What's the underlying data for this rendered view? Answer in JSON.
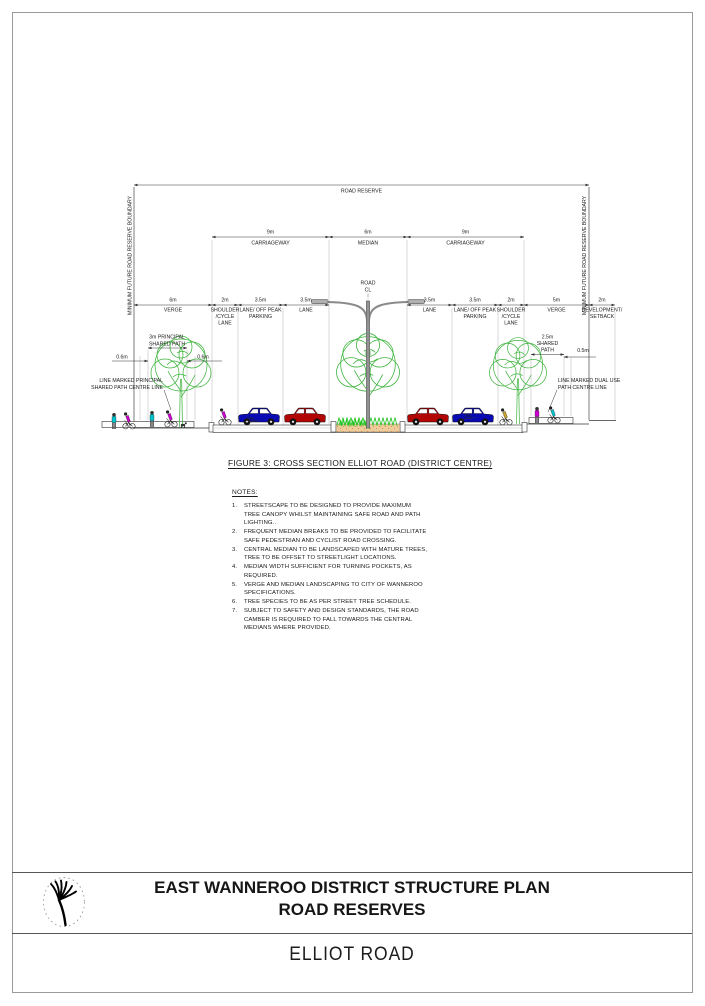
{
  "colors": {
    "car_red": "#b40505",
    "car_blue": "#0a0ab4",
    "tree_green": "#3db33d",
    "grass_green": "#1fc41f",
    "median_sand": "#f0cb9b",
    "person_cyan": "#00c2cc",
    "person_magenta": "#cc00cc",
    "person_yellow": "#c9a02e"
  },
  "drawing": {
    "road_reserve_label": "ROAD RESERVE",
    "boundary_left": "MINIMUM FUTURE ROAD RESERVE BOUNDARY",
    "boundary_right": "MINIMUM FUTURE ROAD RESERVE BOUNDARY",
    "road_cl": {
      "line1": "ROAD",
      "line2": "CL"
    },
    "row2": [
      {
        "value": "9m",
        "label": "CARRIAGEWAY"
      },
      {
        "value": "6m",
        "label": "MEDIAN"
      },
      {
        "value": "9m",
        "label": "CARRIAGEWAY"
      }
    ],
    "row3": {
      "verge_l": {
        "value": "6m",
        "l1": "VERGE"
      },
      "shoulder_l": {
        "value": "2m",
        "l1": "SHOULDER",
        "l2": "/CYCLE",
        "l3": "LANE"
      },
      "parking_l": {
        "value": "3.5m",
        "l1": "LANE/ OFF PEAK",
        "l2": "PARKING"
      },
      "lane_l": {
        "value": "3.5m",
        "l1": "LANE"
      },
      "lane_r": {
        "value": "3.5m",
        "l1": "LANE"
      },
      "parking_r": {
        "value": "3.5m",
        "l1": "LANE/ OFF PEAK",
        "l2": "PARKING"
      },
      "shoulder_r": {
        "value": "2m",
        "l1": "SHOULDER",
        "l2": "/CYCLE",
        "l3": "LANE"
      },
      "verge_r": {
        "value": "5m",
        "l1": "VERGE"
      },
      "setback": {
        "value": "2m",
        "l1": "DEVELOPMENT/",
        "l2": "SETBACK"
      }
    },
    "path_l": {
      "dim_line1": "3m PRINCIPAL",
      "dim_line2": "SHARED PATH",
      "offset_left": "0.6m",
      "offset_right": "0.6m"
    },
    "path_r": {
      "dim_line1": "2.5m",
      "dim_line2": "SHARED",
      "dim_line3": "PATH",
      "offset": "0.5m"
    },
    "callout_left": {
      "line1": "LINE MARKED PRINCIPAL",
      "line2": "SHARED PATH CENTRE LINE"
    },
    "callout_right": {
      "line1": "LINE MARKED DUAL USE",
      "line2": "PATH CENTRE LINE"
    },
    "slope_left": "2%",
    "slope_right": "2%"
  },
  "figure_caption": "FIGURE 3: CROSS SECTION ELLIOT ROAD (DISTRICT CENTRE)",
  "notes": {
    "heading": "NOTES:",
    "items": [
      {
        "num": "1.",
        "text": "STREETSCAPE TO BE DESIGNED TO PROVIDE MAXIMUM TREE CANOPY WHILST MAINTAINING SAFE ROAD AND PATH LIGHTING.."
      },
      {
        "num": "2.",
        "text": "FREQUENT MEDIAN BREAKS TO BE PROVIDED TO FACILITATE SAFE PEDESTRIAN AND CYCLIST ROAD CROSSING."
      },
      {
        "num": "3.",
        "text": "CENTRAL MEDIAN TO BE LANDSCAPED WITH MATURE TREES, TREE TO BE OFFSET TO STREETLIGHT LOCATIONS."
      },
      {
        "num": "4.",
        "text": "MEDIAN WIDTH SUFFICIENT FOR TURNING POCKETS, AS REQUIRED."
      },
      {
        "num": "5.",
        "text": "VERGE AND MEDIAN LANDSCAPING TO CITY OF WANNEROO SPECIFICATIONS."
      },
      {
        "num": "6.",
        "text": "TREE SPECIES TO BE AS PER STREET TREE SCHEDULE."
      },
      {
        "num": "7.",
        "text": "SUBJECT TO SAFETY AND DESIGN STANDARDS, THE ROAD CAMBER IS REQUIRED TO FALL TOWARDS THE CENTRAL MEDIANS WHERE PROVIDED."
      }
    ]
  },
  "title_block": {
    "title_line1": "EAST WANNEROO DISTRICT STRUCTURE PLAN",
    "title_line2": "ROAD RESERVES",
    "drawing_name": "ELLIOT ROAD"
  }
}
